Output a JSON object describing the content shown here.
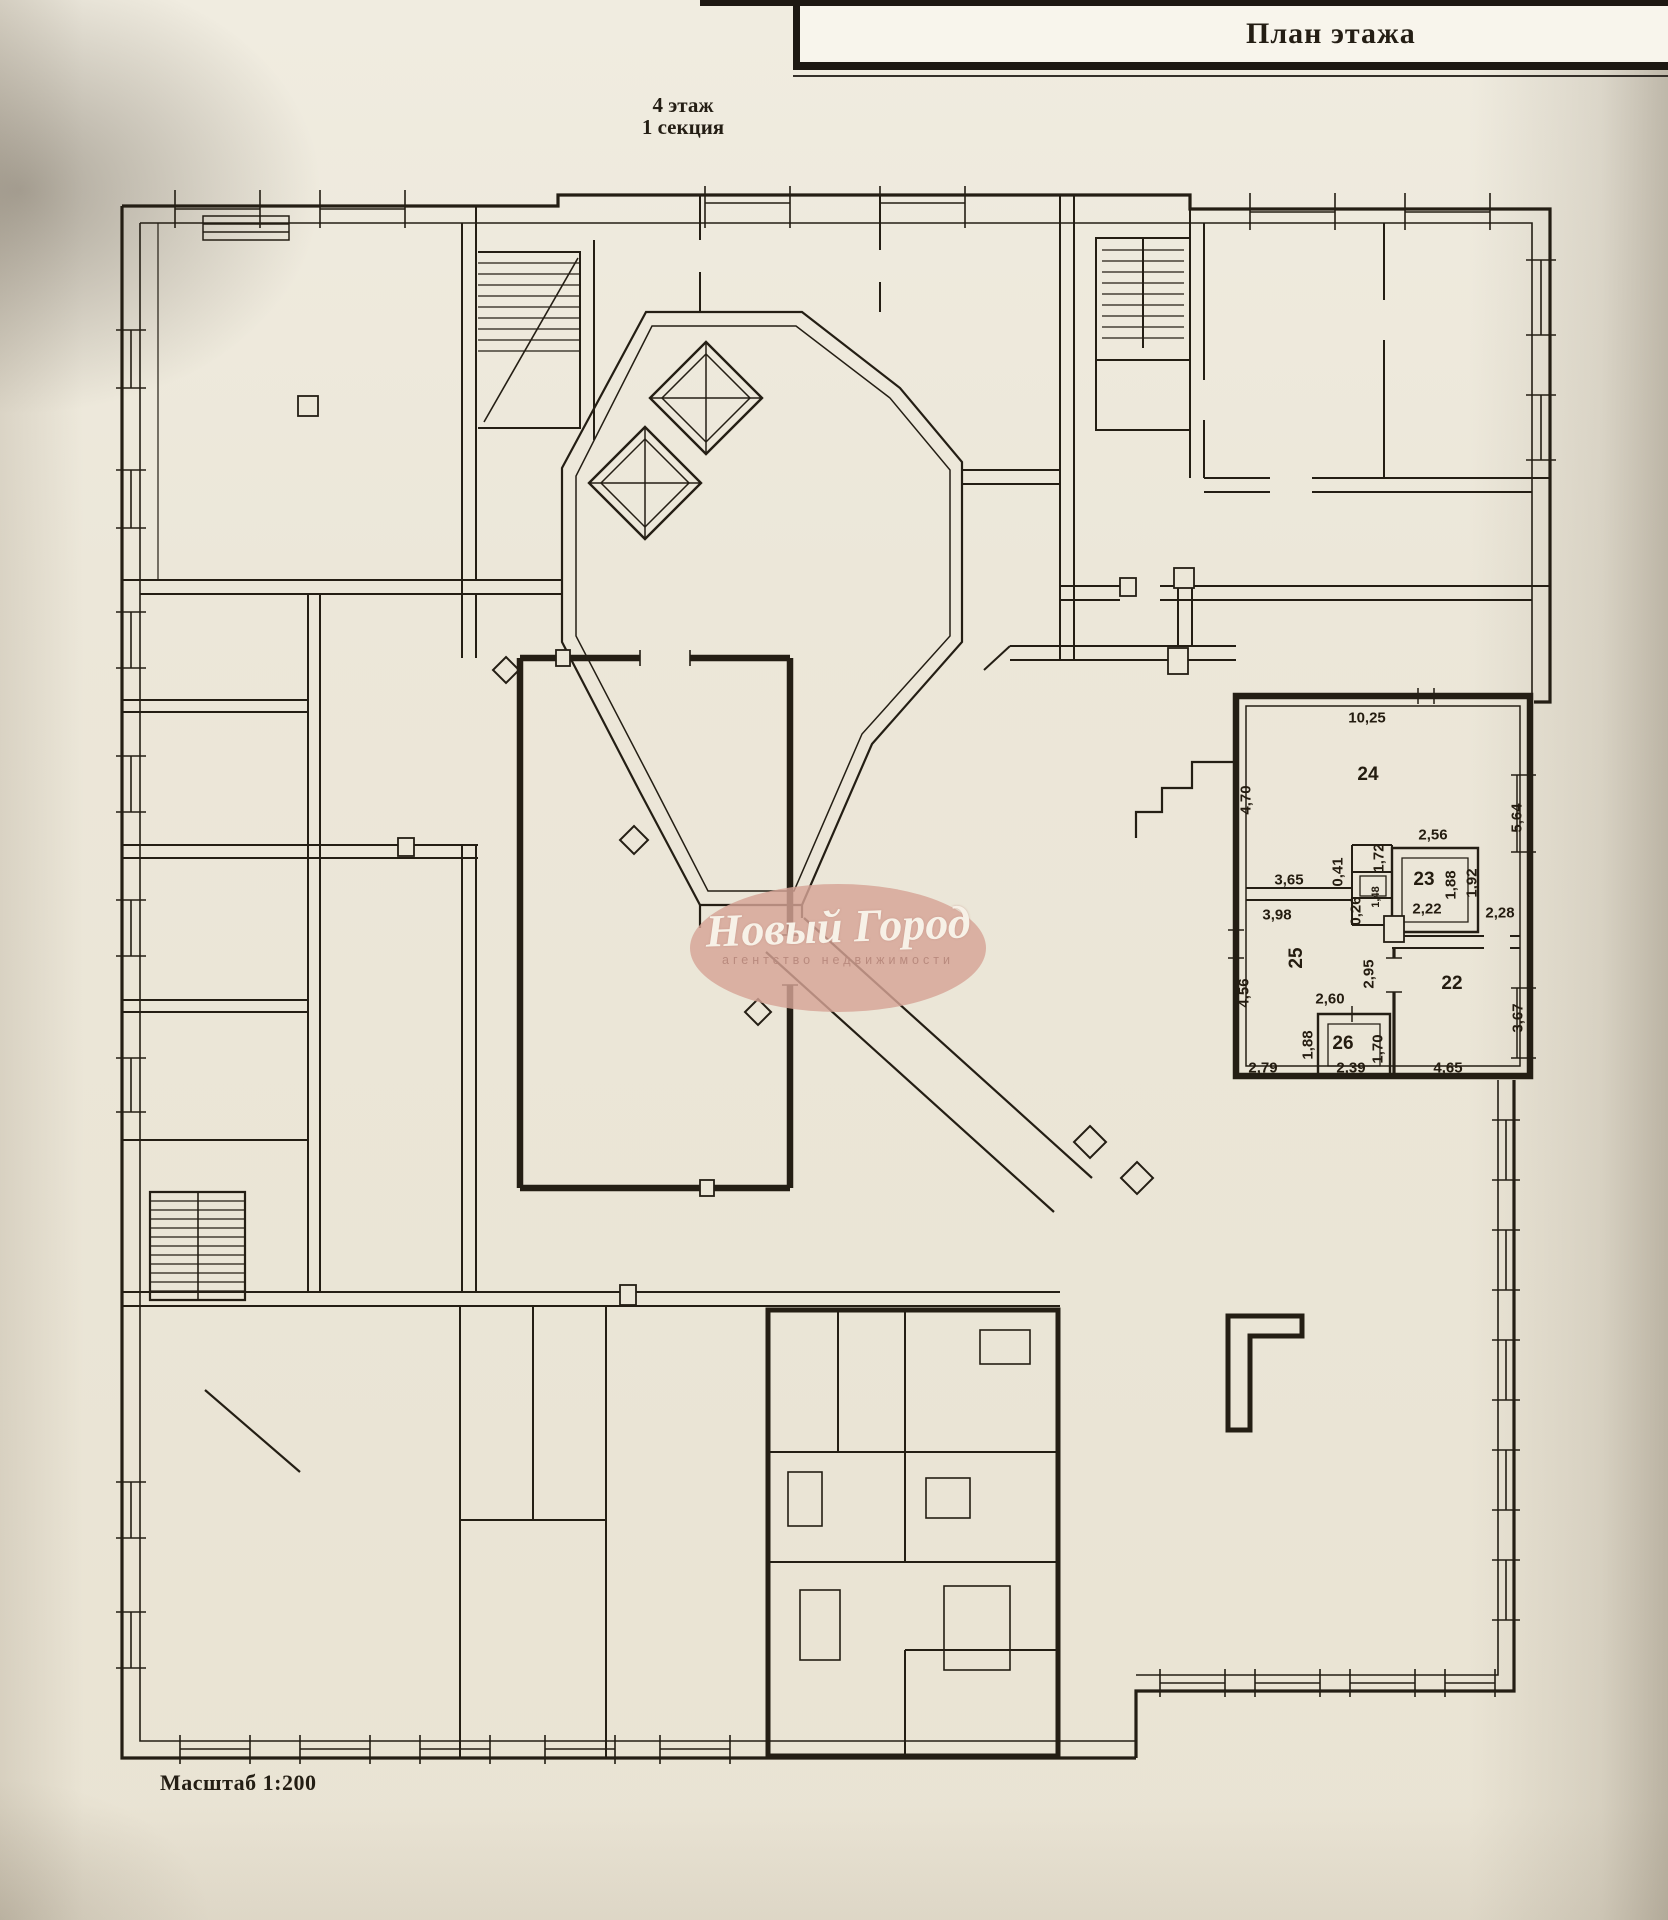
{
  "document": {
    "title_block": {
      "title": "План этажа"
    },
    "floor_label": {
      "floor": "4 этаж",
      "section": "1 секция"
    },
    "scale_label": "Масштаб 1:200",
    "watermark": {
      "name": "Новый Город",
      "subtitle": "агентство недвижимости"
    }
  },
  "plan": {
    "rooms": [
      {
        "number": "24",
        "x": 1368,
        "y": 775,
        "rot": 0
      },
      {
        "number": "23",
        "x": 1424,
        "y": 880,
        "rot": 0
      },
      {
        "number": "25",
        "x": 1297,
        "y": 958,
        "rot": 90
      },
      {
        "number": "22",
        "x": 1452,
        "y": 984,
        "rot": 0
      },
      {
        "number": "26",
        "x": 1343,
        "y": 1044,
        "rot": 0
      }
    ],
    "dimensions": [
      {
        "text": "10,25",
        "x": 1367,
        "y": 718,
        "rot": 0
      },
      {
        "text": "4,70",
        "x": 1246,
        "y": 800,
        "rot": 90
      },
      {
        "text": "5,64",
        "x": 1517,
        "y": 818,
        "rot": 90
      },
      {
        "text": "2,56",
        "x": 1433,
        "y": 835,
        "rot": 0
      },
      {
        "text": "3,65",
        "x": 1289,
        "y": 880,
        "rot": 0
      },
      {
        "text": "0,41",
        "x": 1338,
        "y": 872,
        "rot": 90
      },
      {
        "text": "1,72",
        "x": 1379,
        "y": 858,
        "rot": 90
      },
      {
        "text": "1,48",
        "x": 1376,
        "y": 897,
        "rot": 90,
        "small": true
      },
      {
        "text": "1,88",
        "x": 1451,
        "y": 885,
        "rot": 90
      },
      {
        "text": "1,92",
        "x": 1472,
        "y": 883,
        "rot": 90
      },
      {
        "text": "2,22",
        "x": 1427,
        "y": 909,
        "rot": 0
      },
      {
        "text": "2,28",
        "x": 1500,
        "y": 913,
        "rot": 0
      },
      {
        "text": "3,98",
        "x": 1277,
        "y": 915,
        "rot": 0
      },
      {
        "text": "0,26",
        "x": 1356,
        "y": 911,
        "rot": 90
      },
      {
        "text": "4,56",
        "x": 1244,
        "y": 993,
        "rot": 90
      },
      {
        "text": "2,95",
        "x": 1369,
        "y": 974,
        "rot": 90
      },
      {
        "text": "2,60",
        "x": 1330,
        "y": 999,
        "rot": 0
      },
      {
        "text": "3,67",
        "x": 1518,
        "y": 1018,
        "rot": 90
      },
      {
        "text": "1,88",
        "x": 1308,
        "y": 1045,
        "rot": 90
      },
      {
        "text": "1,70",
        "x": 1378,
        "y": 1049,
        "rot": 90
      },
      {
        "text": "2,79",
        "x": 1263,
        "y": 1068,
        "rot": 0
      },
      {
        "text": "2,39",
        "x": 1351,
        "y": 1068,
        "rot": 0
      },
      {
        "text": "4,65",
        "x": 1448,
        "y": 1068,
        "rot": 0
      }
    ]
  },
  "colors": {
    "ink": "#241e14",
    "page": "#ece7d9",
    "watermark_fill": "#d5a496",
    "watermark_name": "#f7f1e7",
    "watermark_subtitle": "#b98a7e",
    "title_band": "#f8f5ec"
  }
}
